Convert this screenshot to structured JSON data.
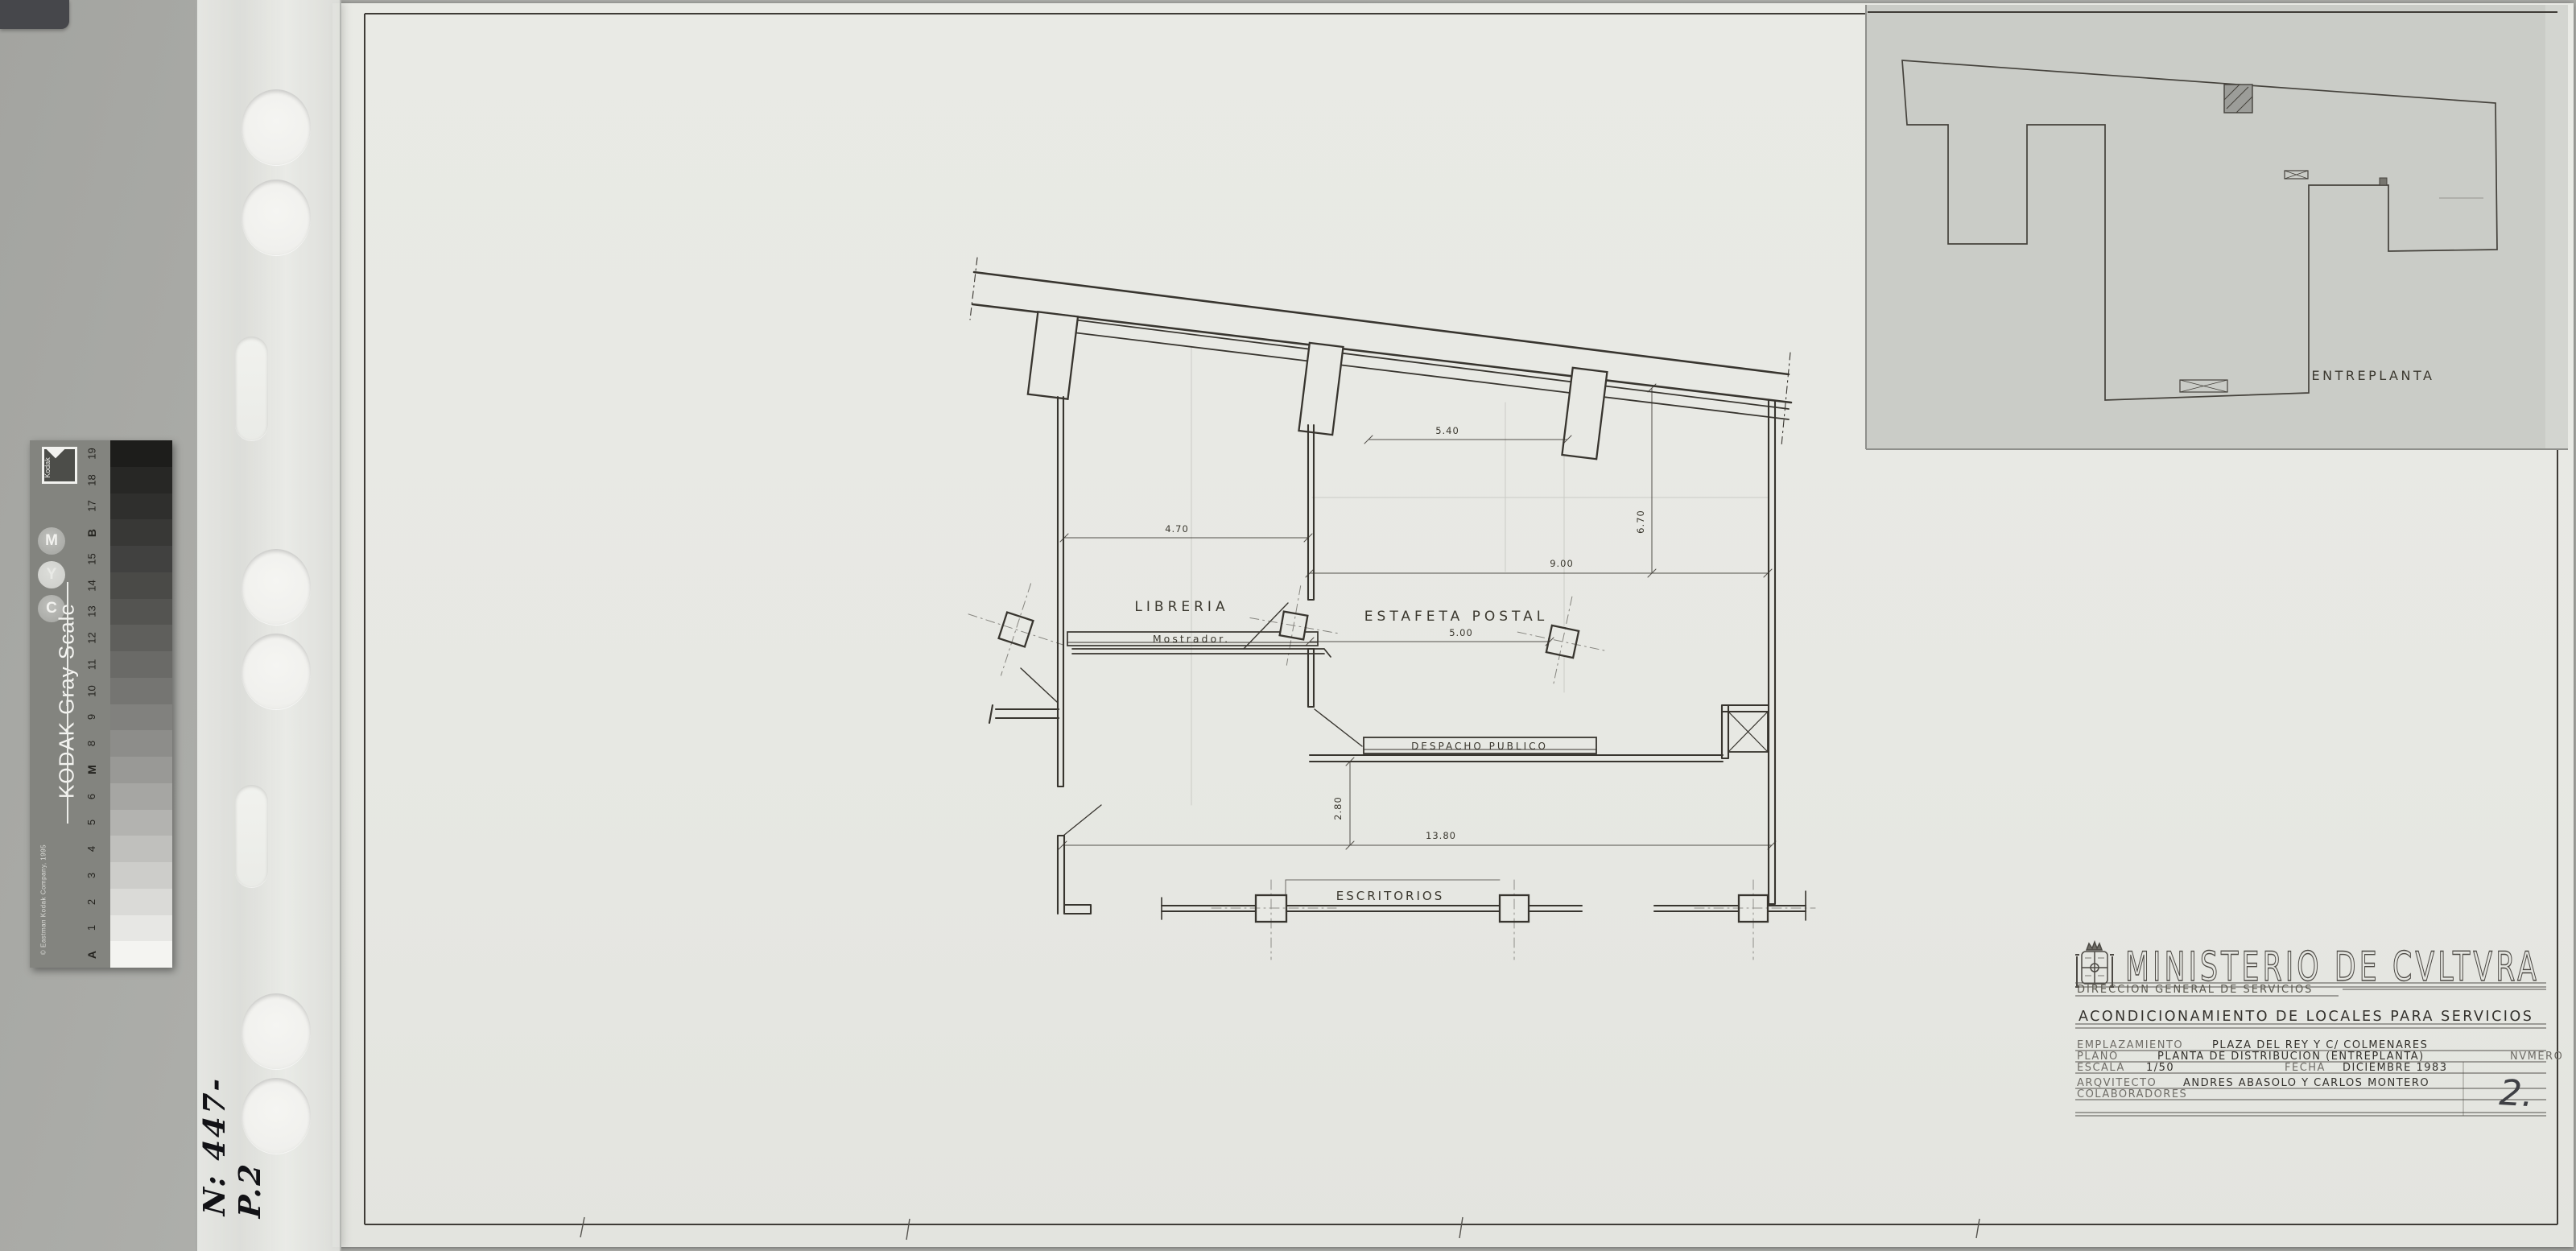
{
  "sheet": {
    "plan": {
      "rooms": {
        "libreria": "LIBRERIA",
        "mostrador": "Mostrador.",
        "estafeta": "ESTAFETA POSTAL",
        "despacho": "DESPACHO PUBLICO",
        "escritorios": "ESCRITORIOS"
      },
      "dimensions": {
        "libreria_width": "4.70",
        "estafeta_bay": "5.40",
        "estafeta_length": "9.00",
        "estafeta_half": "5.00",
        "estafeta_depth": "6.70",
        "total_length": "13.80",
        "despacho_offset": "2.80"
      }
    },
    "inset": {
      "label": "ENTREPLANTA"
    },
    "title_block": {
      "ministry": "MINISTERIO DE CVLTVRA",
      "department": "DIRECCION GENERAL DE SERVICIOS",
      "project": "ACONDICIONAMIENTO DE LOCALES PARA SERVICIOS",
      "emplazamiento_label": "EMPLAZAMIENTO",
      "emplazamiento_value": "PLAZA DEL REY Y C/ COLMENARES",
      "plano_label": "PLANO",
      "plano_value": "PLANTA DE DISTRIBUCION (ENTREPLANTA)",
      "numero_label": "NVMERO",
      "numero_value": "2.",
      "escala_label": "ESCALA",
      "escala_value": "1/50",
      "fecha_label": "FECHA",
      "fecha_value": "DICIEMBRE 1983",
      "arquitecto_label": "ARQVITECTO",
      "arquitecto_value": "ANDRES ABASOLO Y CARLOS MONTERO",
      "colaboradores_label": "COLABORADORES"
    }
  },
  "kodak_strip": {
    "brand": "KODAK Gray Scale",
    "copyright": "© Eastman Kodak Company, 1995",
    "logo_text": "Kodak",
    "circles": [
      "C",
      "Y",
      "M"
    ],
    "step_labels": [
      "A",
      "1",
      "2",
      "3",
      "4",
      "5",
      "6",
      "M",
      "8",
      "9",
      "10",
      "11",
      "12",
      "13",
      "14",
      "15",
      "B",
      "17",
      "18",
      "19"
    ],
    "step_colors": [
      "#f4f4f1",
      "#e7e7e4",
      "#dadad7",
      "#cdcdca",
      "#c0c0bd",
      "#b3b3b0",
      "#a6a6a3",
      "#999996",
      "#8d8d8a",
      "#81817e",
      "#757572",
      "#6a6a67",
      "#5f5f5c",
      "#545451",
      "#4a4a47",
      "#414140",
      "#383836",
      "#2f2f2d",
      "#272725",
      "#1d1d1b"
    ]
  },
  "annotations": {
    "sleeve_number": "N: 447-P.2"
  },
  "colors": {
    "paper": "#e8e9e4",
    "inset_sheet": "#caccc7",
    "ink": "#38352f",
    "background": "#adaeaa"
  }
}
